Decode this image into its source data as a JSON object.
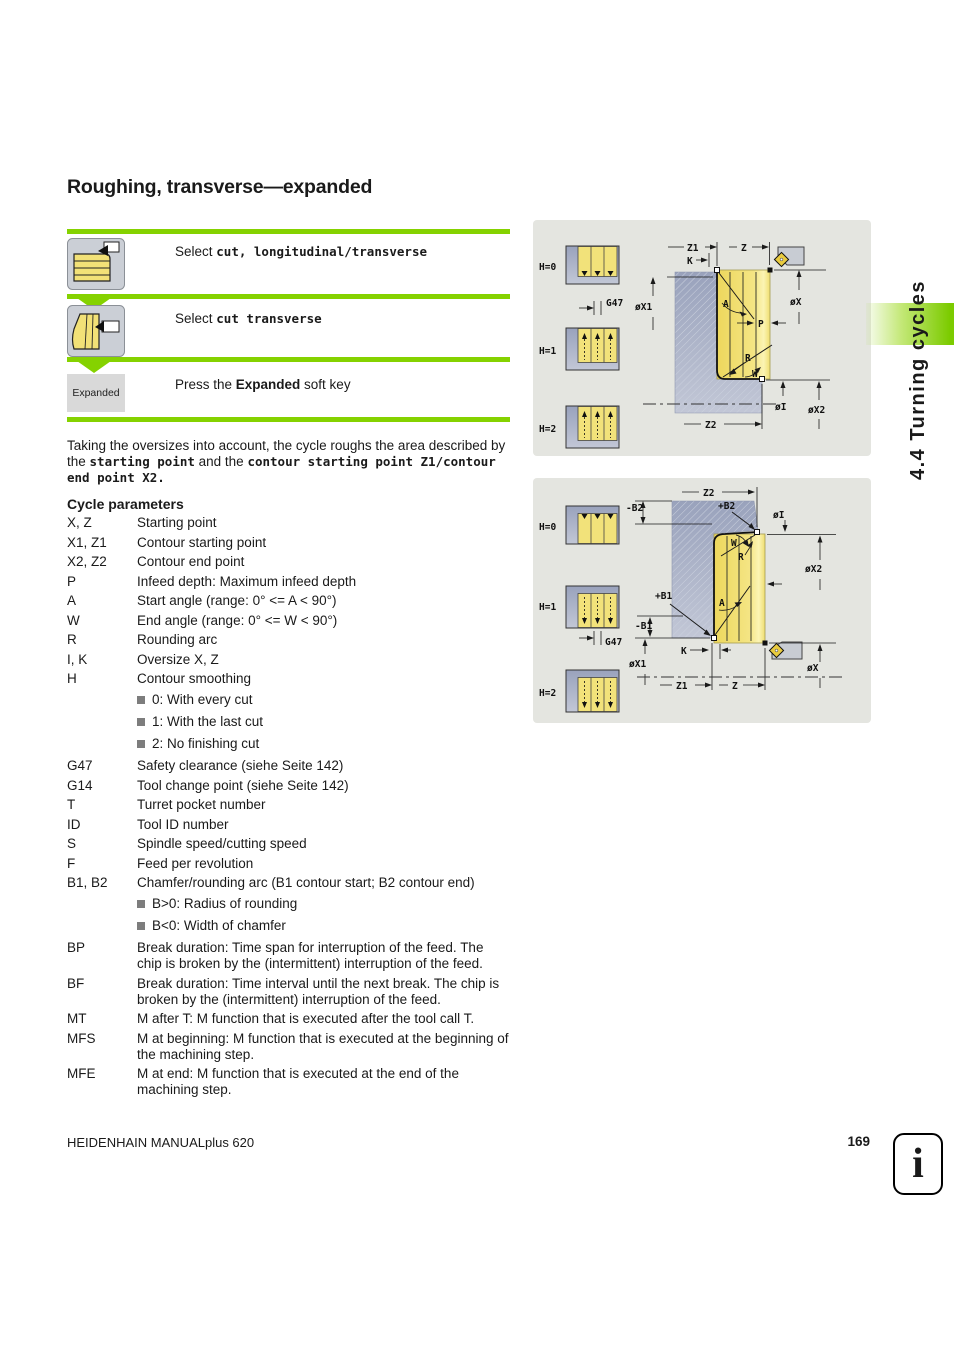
{
  "page": {
    "title": "Roughing, transverse—expanded",
    "sidebar_label": "4.4 Turning cycles",
    "footer_left": "HEIDENHAIN MANUALplus 620",
    "page_number": "169",
    "info_glyph": "i"
  },
  "colors": {
    "accent_green": "#85d200",
    "panel_background": "#e4e5e0",
    "workpiece_yellow": "#f2de72",
    "stock_blue_gray": "#a3abc2",
    "softkey_gray": "#d9d9d9"
  },
  "steps": {
    "step1": {
      "prefix": "Select ",
      "code": "cut, longitudinal/transverse"
    },
    "step2": {
      "prefix": "Select ",
      "code": "cut transverse"
    },
    "step3": {
      "prefix": "Press the ",
      "bold": "Expanded",
      "suffix": " soft key",
      "softkey_label": "Expanded"
    }
  },
  "intro": {
    "s1": "Taking the oversizes into account, the cycle roughs the area described by the ",
    "s2": "starting point",
    "s3": " and the ",
    "s4": "contour starting point Z1/contour end point X2."
  },
  "parameters": {
    "heading": "Cycle parameters",
    "rows": [
      {
        "label": "X, Z",
        "desc": "Starting point"
      },
      {
        "label": "X1, Z1",
        "desc": "Contour starting point"
      },
      {
        "label": "X2, Z2",
        "desc": "Contour end point"
      },
      {
        "label": "P",
        "desc": "Infeed depth: Maximum infeed depth"
      },
      {
        "label": "A",
        "desc": "Start angle (range: 0° <= A < 90°)"
      },
      {
        "label": "W",
        "desc": "End angle (range: 0° <= W < 90°)"
      },
      {
        "label": "R",
        "desc": "Rounding arc"
      },
      {
        "label": "I, K",
        "desc": "Oversize X, Z"
      },
      {
        "label": "H",
        "desc": "Contour smoothing",
        "bullets": [
          "0: With every cut",
          "1: With the last cut",
          "2: No finishing cut"
        ]
      },
      {
        "label": "G47",
        "desc": "Safety clearance (siehe Seite 142)"
      },
      {
        "label": "G14",
        "desc": "Tool change point (siehe Seite 142)"
      },
      {
        "label": "T",
        "desc": "Turret pocket number"
      },
      {
        "label": "ID",
        "desc": "Tool ID number"
      },
      {
        "label": "S",
        "desc": "Spindle speed/cutting speed"
      },
      {
        "label": "F",
        "desc": "Feed per revolution"
      },
      {
        "label": "B1, B2",
        "desc": "Chamfer/rounding arc (B1 contour start; B2 contour end)",
        "bullets": [
          "B>0: Radius of rounding",
          "B<0: Width of chamfer"
        ]
      },
      {
        "label": "BP",
        "desc": "Break duration: Time span for interruption of the feed. The chip is broken by the (intermittent) interruption of the feed."
      },
      {
        "label": "BF",
        "desc": "Break duration: Time interval until the next break. The chip is broken by the (intermittent) interruption of the feed."
      },
      {
        "label": "MT",
        "desc": "M after T: M function that is executed after the tool call T."
      },
      {
        "label": "MFS",
        "desc": "M at beginning: M function that is executed at the beginning of the machining step."
      },
      {
        "label": "MFE",
        "desc": "M at end: M function that is executed at the end of the machining step."
      }
    ]
  },
  "diagrams": {
    "fig1": {
      "labels": {
        "h0": "H=0",
        "h1": "H=1",
        "h2": "H=2",
        "g47": "G47",
        "z1": "Z1",
        "z": "Z",
        "k": "K",
        "ox1": "øX1",
        "ox": "øX",
        "a": "A",
        "p": "P",
        "r": "R",
        "w": "W",
        "oi": "øI",
        "ox2": "øX2",
        "z2": "Z2"
      }
    },
    "fig2": {
      "labels": {
        "h0": "H=0",
        "h1": "H=1",
        "h2": "H=2",
        "g47": "G47",
        "z2": "Z2",
        "b2_minus": "-B2",
        "b2_plus": "+B2",
        "oi": "øI",
        "ox2": "øX2",
        "w": "W",
        "r": "R",
        "a": "A",
        "b1_plus": "+B1",
        "b1_minus": "-B1",
        "ox1": "øX1",
        "k": "K",
        "z1": "Z1",
        "z": "Z",
        "ox": "øX"
      }
    }
  }
}
